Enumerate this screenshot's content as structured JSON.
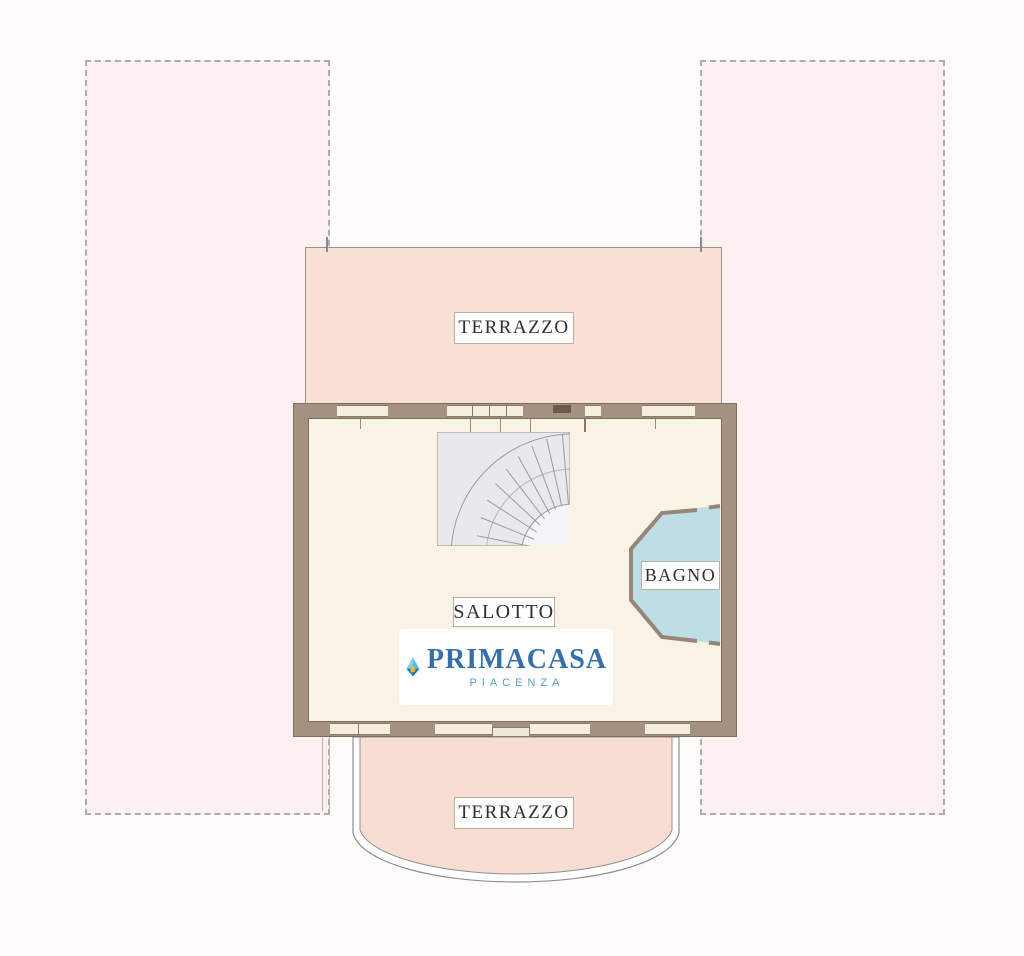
{
  "plan": {
    "type": "floor-plan",
    "rooms": {
      "terrace_top": {
        "label": "TERRAZZO"
      },
      "living_room": {
        "label": "SALOTTO"
      },
      "bathroom": {
        "label": "BAGNO"
      },
      "terrace_bottom": {
        "label": "TERRAZZO"
      }
    },
    "features": [
      "curved-staircase",
      "octagonal-bathroom-bay",
      "curved-lower-terrace"
    ]
  },
  "logo": {
    "brand": "PRIMACASA",
    "city": "PIACENZA",
    "brand_color": "#376fab",
    "city_color": "#55a2c4"
  },
  "colors": {
    "wall": "#a5917f",
    "interior_floor": "#f8f3e4",
    "terrace_fill": "#f9e0d3",
    "bathroom_fill": "#bedee6",
    "outdoor_fill": "#fcf0f1",
    "stairs_fill": "#e9e9ec",
    "label_bg": "#fefefe"
  }
}
